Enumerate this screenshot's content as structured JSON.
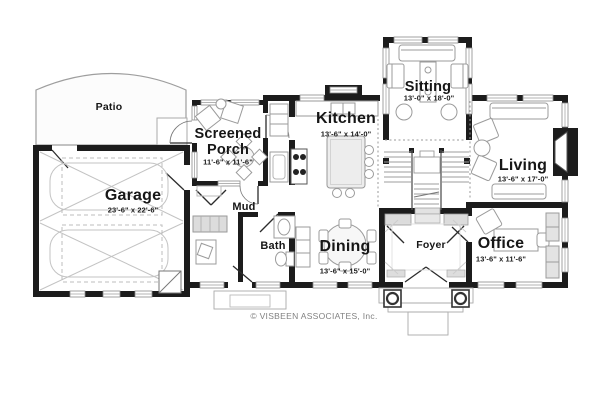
{
  "plan_title": "First floor plan",
  "rooms": {
    "patio": {
      "label": "Patio",
      "dims": ""
    },
    "garage": {
      "label": "Garage",
      "dims": "23'-6\" x 22'-6\""
    },
    "porch": {
      "label": "Screened Porch",
      "dims": "11'-6\" x 11'-6\""
    },
    "kitchen": {
      "label": "Kitchen",
      "dims": "13'-6\" x 14'-0\""
    },
    "sitting": {
      "label": "Sitting",
      "dims": "13'-0\" x 18'-0\""
    },
    "living": {
      "label": "Living",
      "dims": "13'-6\" x 17'-0\""
    },
    "mud": {
      "label": "Mud",
      "dims": ""
    },
    "bath": {
      "label": "Bath",
      "dims": ""
    },
    "dining": {
      "label": "Dining",
      "dims": "13'-6\" x 15'-0\""
    },
    "foyer": {
      "label": "Foyer",
      "dims": ""
    },
    "office": {
      "label": "Office",
      "dims": "13'-6\" x 11'-6\""
    }
  },
  "footer": {
    "copyright": "© VISBEEN ASSOCIATES, Inc."
  },
  "colors": {
    "wall": "#1c1c1c",
    "furniture_line": "#9b9b9b",
    "hatch_fill": "#dcdcdc",
    "copyright_text": "#818181"
  }
}
